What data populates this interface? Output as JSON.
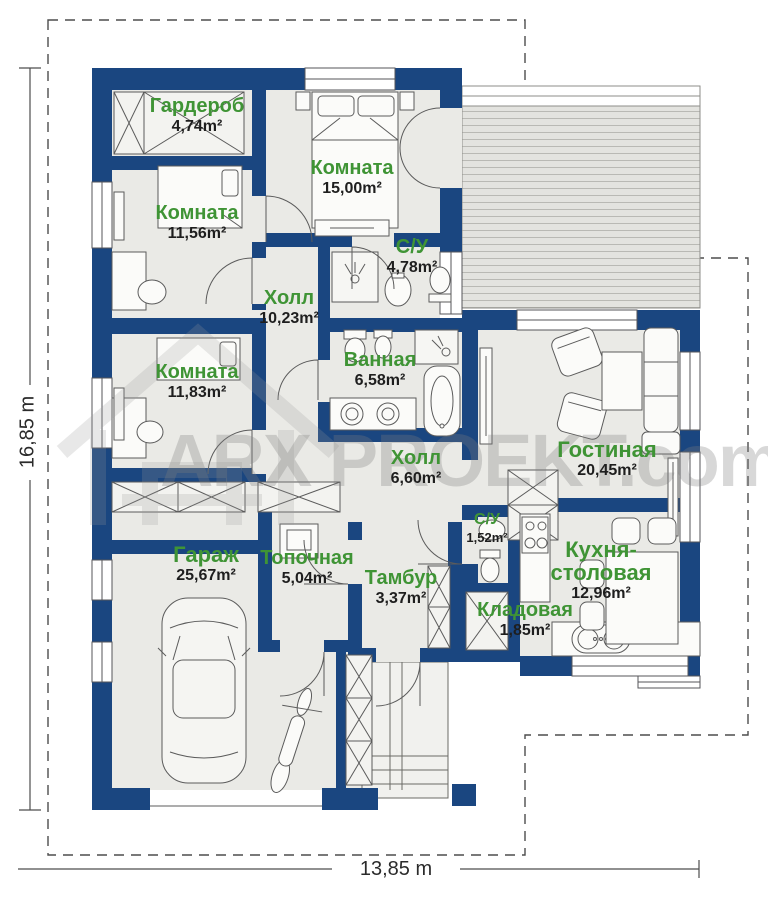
{
  "plan": {
    "watermark": {
      "text": "ARX PROEKT.com"
    },
    "dimensions": {
      "height_label": "16,85 m",
      "width_label": "13,85 m"
    },
    "rooms": [
      {
        "id": "garderob",
        "name": "Гардероб",
        "area": "4,74m²"
      },
      {
        "id": "komnata-15",
        "name": "Комната",
        "area": "15,00m²"
      },
      {
        "id": "komnata-11-56",
        "name": "Комната",
        "area": "11,56m²"
      },
      {
        "id": "su-4-78",
        "name": "С/У",
        "area": "4,78m²"
      },
      {
        "id": "holl-10-23",
        "name": "Холл",
        "area": "10,23m²"
      },
      {
        "id": "komnata-11-83",
        "name": "Комната",
        "area": "11,83m²"
      },
      {
        "id": "vannaya",
        "name": "Ванная",
        "area": "6,58m²"
      },
      {
        "id": "gostinaya",
        "name": "Гостиная",
        "area": "20,45m²"
      },
      {
        "id": "holl-6-60",
        "name": "Холл",
        "area": "6,60m²"
      },
      {
        "id": "su-1-52",
        "name": "С/У",
        "area": "1,52m²"
      },
      {
        "id": "garazh",
        "name": "Гараж",
        "area": "25,67m²"
      },
      {
        "id": "topochnaya",
        "name": "Топочная",
        "area": "5,04m²"
      },
      {
        "id": "tambur",
        "name": "Тамбур",
        "area": "3,37m²"
      },
      {
        "id": "kladovaya",
        "name": "Кладовая",
        "area": "1,85m²"
      },
      {
        "id": "kuhnya",
        "name": "Кухня-столовая",
        "area": "12,96m²"
      }
    ],
    "colors": {
      "wall": "#1a4680",
      "room_label_green": "#3f9435",
      "floor": "#eaeae6"
    }
  }
}
